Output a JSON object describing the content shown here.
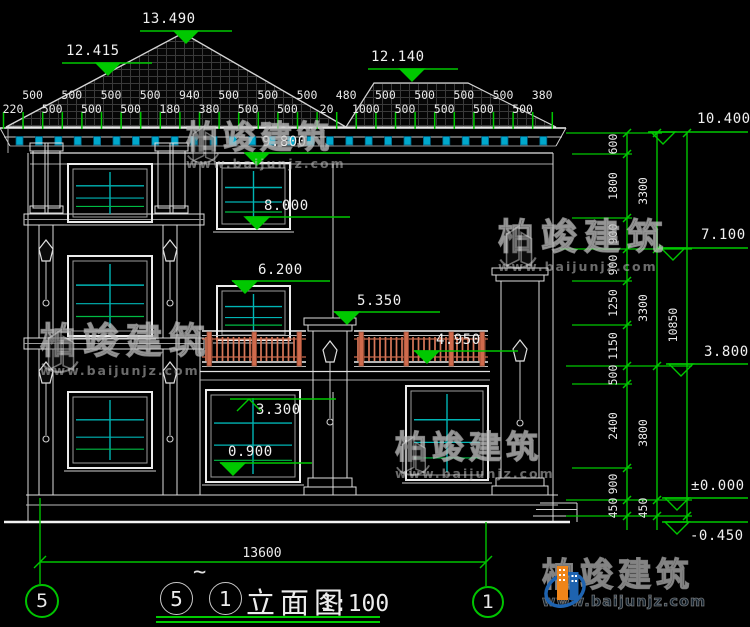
{
  "drawing": {
    "title": {
      "axis_from": "5",
      "tilde": "~",
      "axis_to": "1",
      "name": "立面图",
      "scale": "1:100"
    },
    "bottom_axes": {
      "left": "5",
      "right": "1"
    },
    "bottom_overall_dim": "13600",
    "top_dims": [
      "220",
      "500",
      "500",
      "500",
      "500",
      "500",
      "500",
      "500",
      "180",
      "940",
      "380",
      "500",
      "500",
      "500",
      "500",
      "500",
      "20",
      "480",
      "1000",
      "500",
      "500",
      "500",
      "500",
      "500",
      "500",
      "500",
      "500",
      "380"
    ],
    "elevations": [
      "13.490",
      "12.415",
      "12.140",
      "9.800",
      "8.000",
      "6.200",
      "5.350",
      "4.950",
      "3.300",
      "0.900",
      "10.400",
      "7.100",
      "3.800",
      "±0.000",
      "-0.450"
    ],
    "right_dim_chains": {
      "inner": [
        "600",
        "1800",
        "900",
        "900",
        "1250",
        "1150",
        "500",
        "2400",
        "900",
        "450"
      ],
      "middle": [
        "3300",
        "3300",
        "3800",
        "450"
      ],
      "outer": [
        "10850"
      ]
    }
  },
  "watermark": {
    "brand": "柏竣建筑",
    "url": "www.baijunjz.com"
  },
  "colors": {
    "background": "#000000",
    "dimension_green": "#00C400",
    "window_cyan": "#00B4B4",
    "railing_salmon": "#D8795A",
    "logo_blue": "#1E63B0",
    "logo_orange": "#F08519"
  }
}
